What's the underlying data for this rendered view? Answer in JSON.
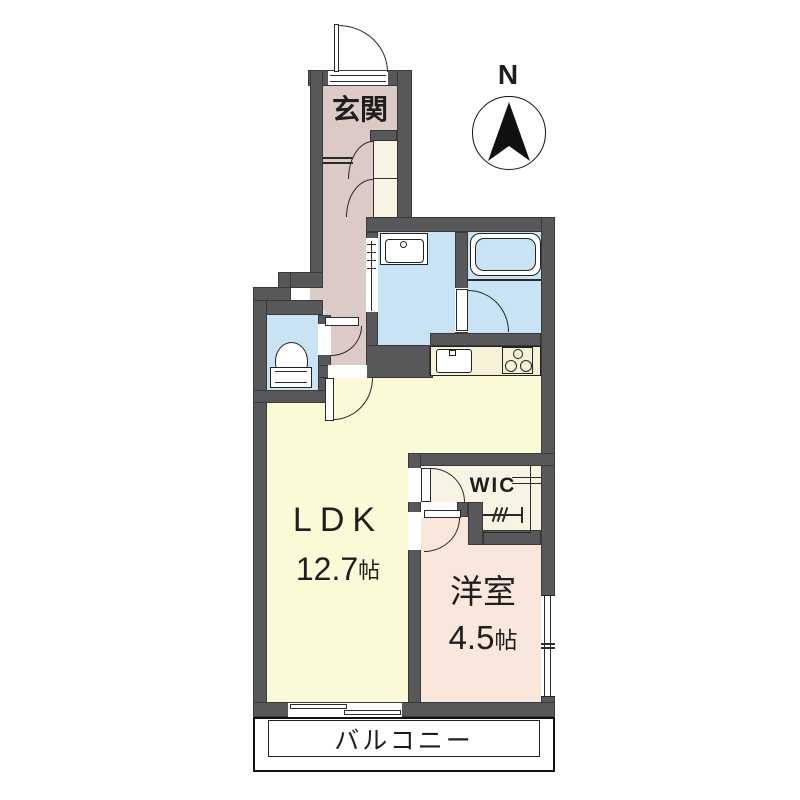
{
  "compass": {
    "north_label": "N"
  },
  "rooms": {
    "genkan": {
      "label": "玄関"
    },
    "ldk": {
      "label": "LDK",
      "size_value": "12.7",
      "size_unit": "帖"
    },
    "western_room": {
      "label": "洋室",
      "size_value": "4.5",
      "size_unit": "帖"
    },
    "wic": {
      "label": "WIC"
    },
    "balcony": {
      "label": "バルコニー"
    }
  },
  "colors": {
    "wall": "#58585b",
    "hallway": "#dccac6",
    "wet": "#c8e4f4",
    "ldk": "#fafad7",
    "western": "#fae7dc",
    "wic": "#f8f4e3",
    "counter": "#f6f2d8",
    "outline": "#1a1a1a"
  }
}
